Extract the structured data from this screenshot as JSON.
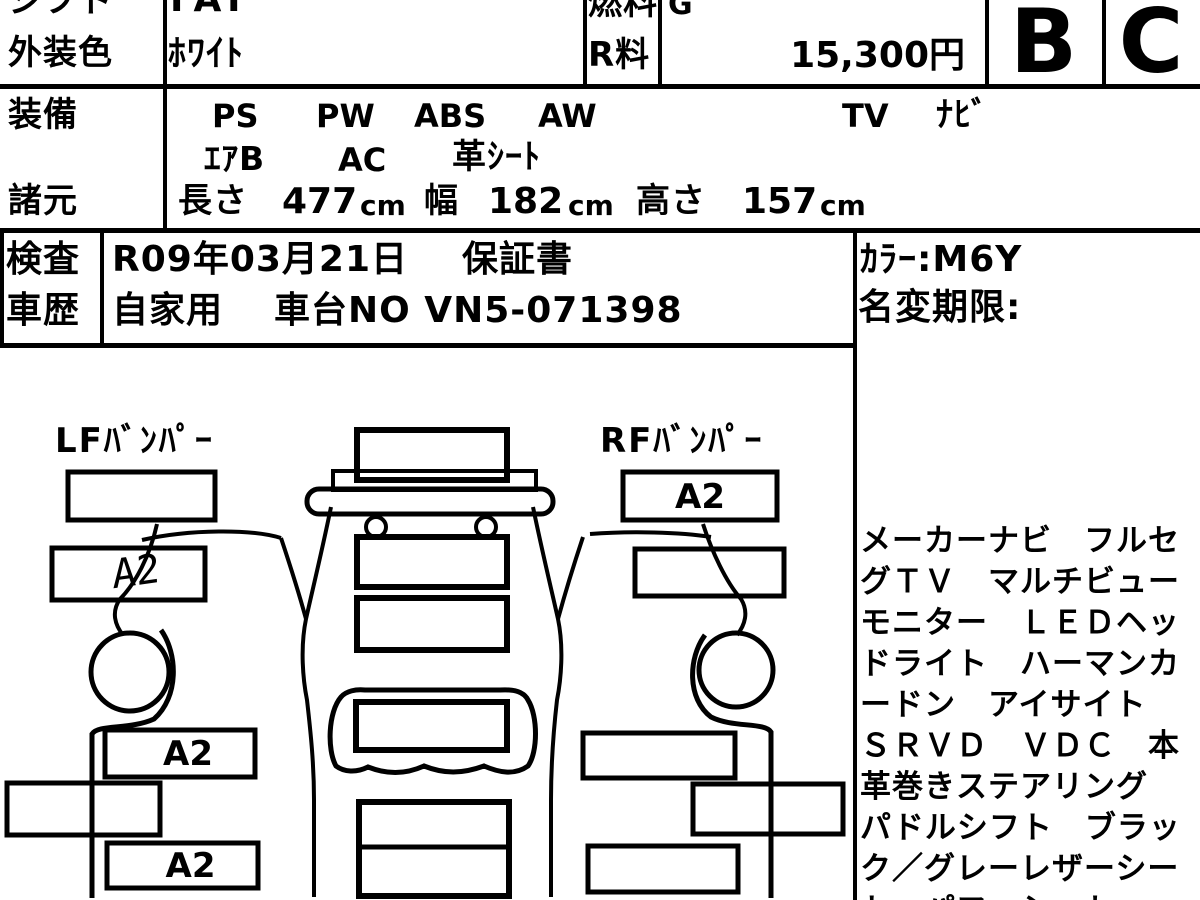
{
  "header": {
    "row1": {
      "label": "シフト",
      "value": "FAT",
      "fuel_label": "燃料",
      "fuel_value": "G"
    },
    "row2": {
      "label": "外装色",
      "value": "ﾎﾜｲﾄ",
      "fee_label": "R料",
      "fee_value": "15,300円"
    },
    "exterior_grade": "B",
    "interior_grade": "C"
  },
  "equipment": {
    "label": "装備",
    "items_line1": [
      "PS",
      "PW",
      "ABS",
      "AW",
      "TV",
      "ﾅﾋﾞ"
    ],
    "items_line2": [
      "ｴｱB",
      "AC",
      "革ｼｰﾄ"
    ]
  },
  "specs": {
    "label": "諸元",
    "length_label": "長さ",
    "length": "477",
    "width_label": "幅",
    "width": "182",
    "height_label": "高さ",
    "height": "157",
    "unit": "cm"
  },
  "inspection": {
    "label": "検査",
    "date": "R09年03月21日",
    "warranty": "保証書"
  },
  "history": {
    "label": "車歴",
    "usage": "自家用",
    "chassis": "車台NO VN5-071398"
  },
  "side_panel": {
    "color": "ｶﾗｰ:M6Y",
    "name_change": "名変期限:",
    "notes": [
      "メーカーナビ　フルセ",
      "グＴＶ　マルチビュー",
      "モニター　ＬＥＤヘッ",
      "ドライト　ハーマンカ",
      "ードン　アイサイト",
      "ＳＲＶＤ　ＶＤＣ　本",
      "革巻きステアリング",
      "パドルシフト　ブラッ",
      "ク／グレーレザーシー",
      "ト　パワーシート"
    ]
  },
  "diagram": {
    "lf_label": "LFﾊﾞﾝﾊﾟｰ",
    "rf_label": "RFﾊﾞﾝﾊﾟｰ",
    "rf_mark": "A2",
    "lf_fender_mark": "A2",
    "left_mark1": "A2",
    "left_mark2": "A2"
  },
  "colors": {
    "ink": "#000000",
    "paper": "#ffffff"
  }
}
